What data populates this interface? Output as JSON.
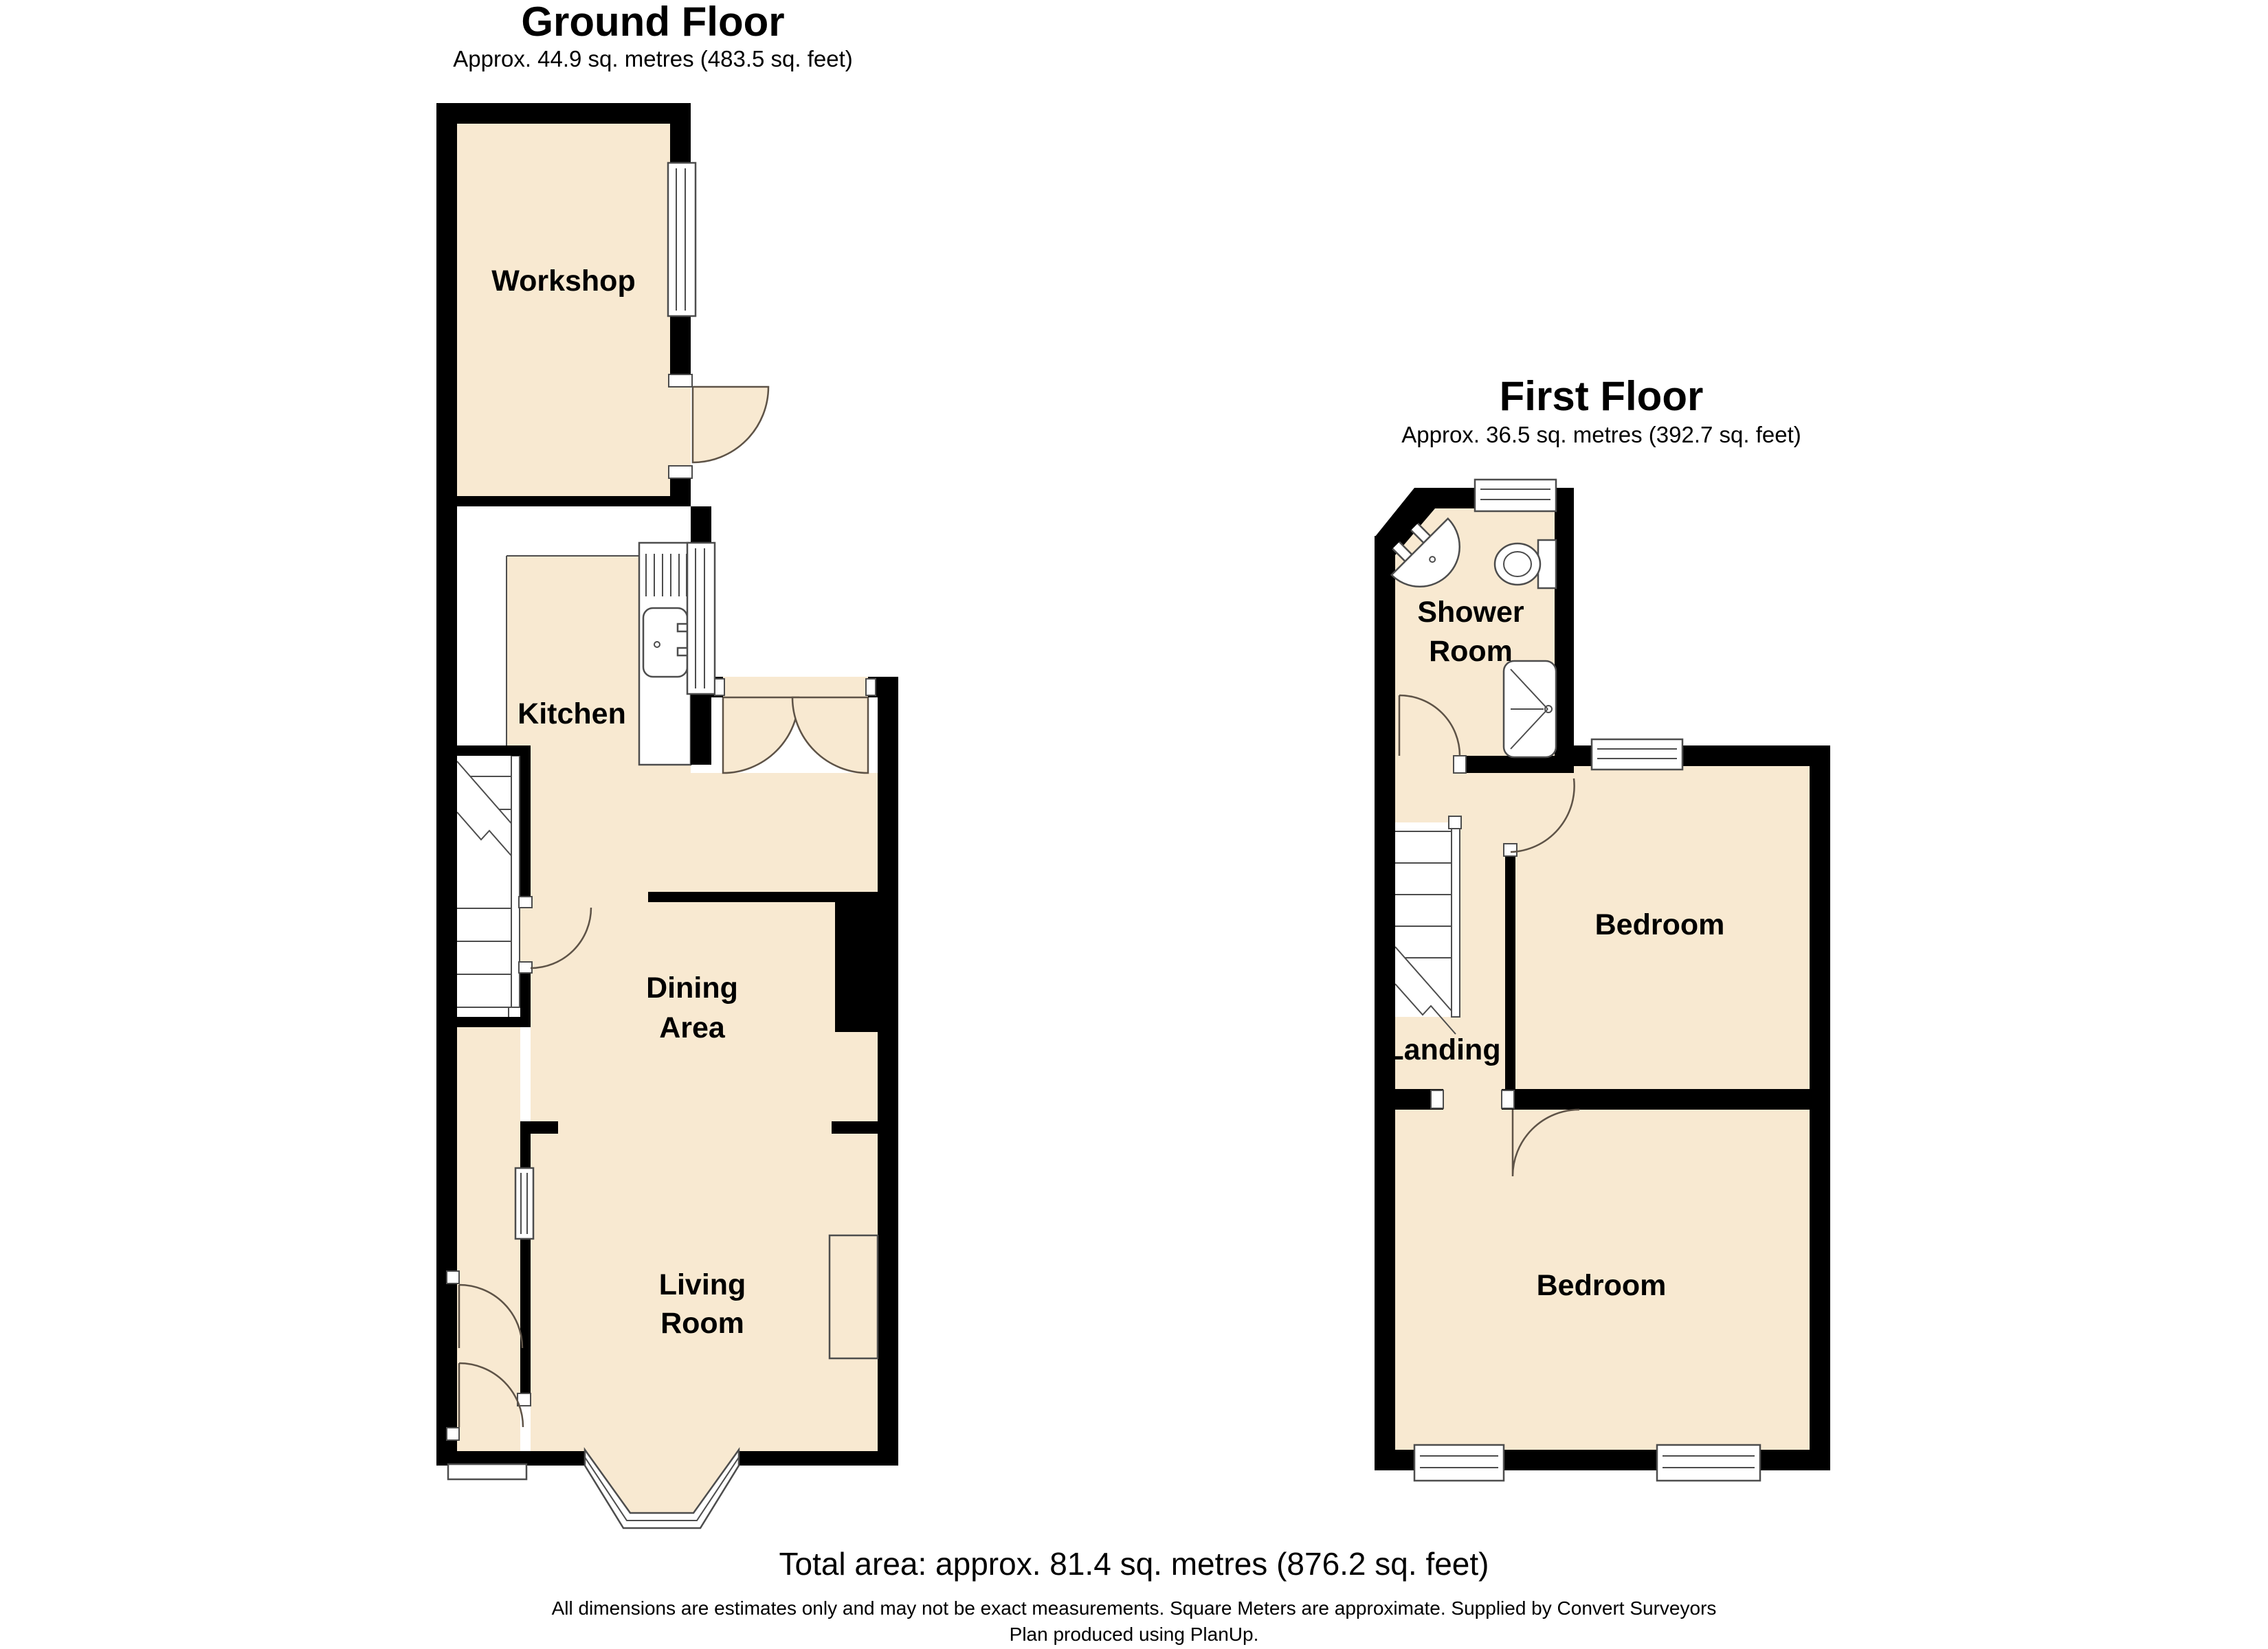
{
  "colors": {
    "room_fill": "#F8E9D1",
    "wall": "#000000",
    "edge": "#4D4D4D",
    "door": "#5E5347",
    "paper": "#FFFFFF"
  },
  "ground_floor": {
    "title": "Ground Floor",
    "subtitle": "Approx. 44.9 sq. metres (483.5 sq. feet)",
    "rooms": {
      "workshop": "Workshop",
      "kitchen": "Kitchen",
      "dining": {
        "line1": "Dining",
        "line2": "Area"
      },
      "living": {
        "line1": "Living",
        "line2": "Room"
      }
    }
  },
  "first_floor": {
    "title": "First Floor",
    "subtitle": "Approx. 36.5 sq. metres (392.7 sq. feet)",
    "rooms": {
      "shower": {
        "line1": "Shower",
        "line2": "Room"
      },
      "bedroom_front": "Bedroom",
      "landing": "Landing",
      "bedroom_back": "Bedroom"
    }
  },
  "footer": {
    "total_area": "Total area: approx. 81.4 sq. metres (876.2 sq. feet)",
    "disclaimer": "All dimensions are estimates only and may not be exact measurements. Square Meters are approximate. Supplied by Convert Surveyors",
    "produced_by": "Plan produced using PlanUp."
  }
}
